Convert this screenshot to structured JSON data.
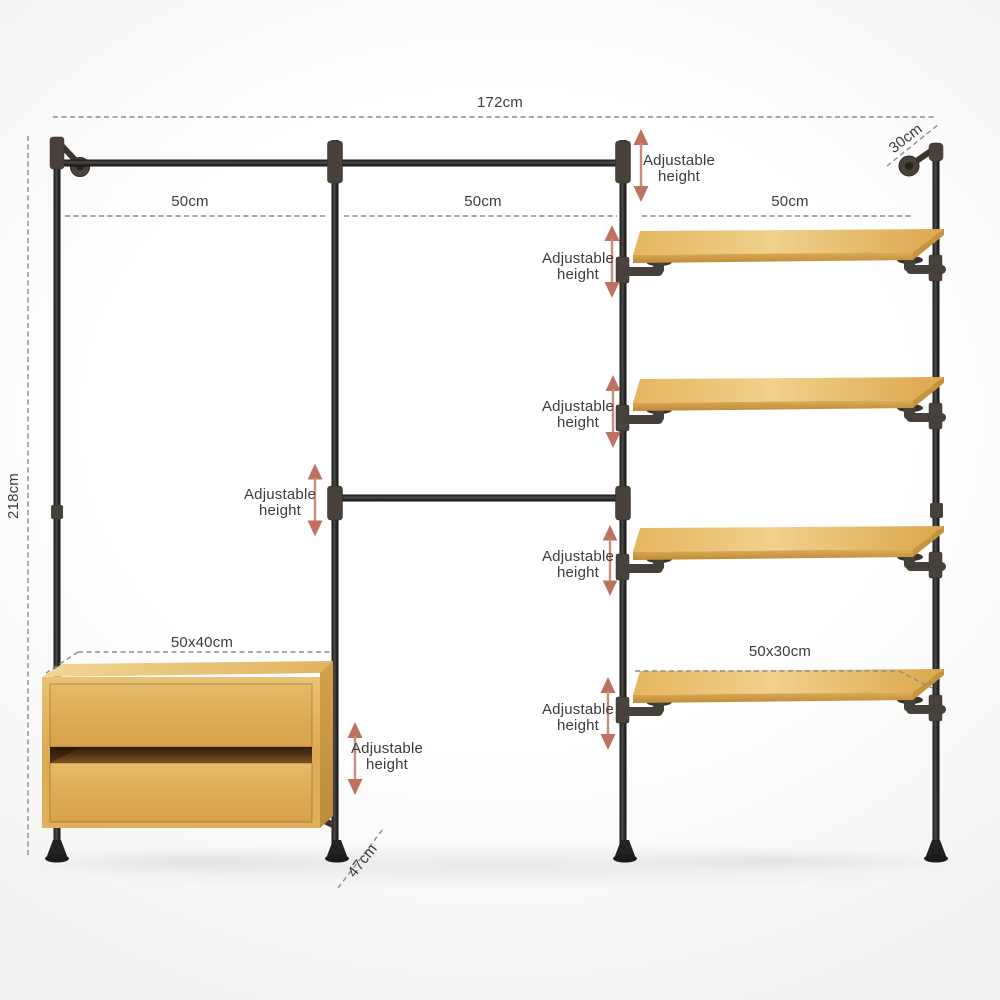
{
  "dimensions": {
    "total_width": "172cm",
    "total_height": "218cm",
    "top_depth": "30cm",
    "base_depth": "47cm",
    "section_widths": [
      "50cm",
      "50cm",
      "50cm"
    ],
    "drawer_unit_top": "50x40cm",
    "shelf_size": "50x30cm"
  },
  "annotations": {
    "adjustable_height": "Adjustable\nheight"
  },
  "colors": {
    "arrow_accent": "#bd725f",
    "arrow_shaft": "#c98c7a",
    "label_text": "#3c3c3c",
    "dash_line": "#8c8c8c",
    "pipe_black": "#1f1f1f",
    "fitting_gray": "#48423a",
    "wood_light": "#f0d18c",
    "wood_dark": "#d9a44c"
  }
}
